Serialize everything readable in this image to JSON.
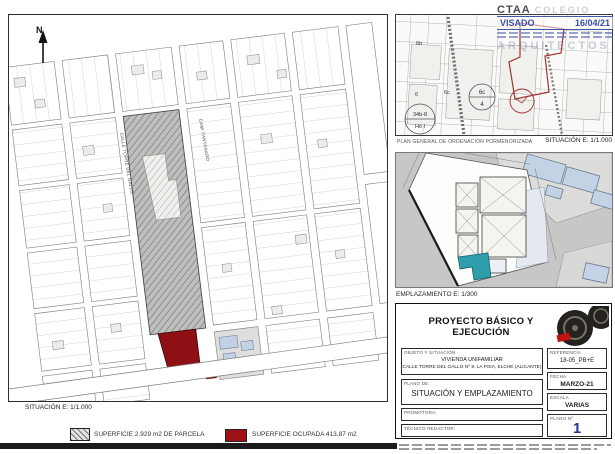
{
  "map": {
    "north": "N",
    "street_left": "CALLE TORRE DEL GALLO",
    "street_right": "CAMI PANTANARO",
    "caption": "SITUACIÓN E: 1/1.000"
  },
  "legend": {
    "parcela_label": "SUPERFICIE 2.929 m2 DE PARCELA",
    "ocupada_label": "SUPERFICIE OCUPADA  413,87 m2"
  },
  "pgou": {
    "caption": "PLAN GENERAL DE ORDENACIÓN PORMENORIZADA",
    "scale": "SITUACIÓN E: 1/1.000",
    "zone_6b": "6b",
    "zone_6c": "6c",
    "zone_6": "6",
    "circle1_top": "6c",
    "circle1_bottom": "4",
    "circle2_top": "34b-8",
    "circle2_bottom": "Ho I"
  },
  "stamp": {
    "org": "CTAA",
    "org_watermark": "COLEGIO",
    "visado": "VISADO",
    "date": "16/04/21",
    "watermark": "ARQUITECTOS"
  },
  "emplazamiento": {
    "caption": "EMPLAZAMIENTO E: 1/300"
  },
  "titleblock": {
    "title": "PROYECTO BÁSICO Y EJECUCIÓN",
    "objeto_label": "OBJETO Y SITUACIÓN",
    "objeto_line1": "VIVIENDA UNIFAMILIAR",
    "objeto_line2": "CALLE TORRE DEL GALLO Nº 9, LA FOIA, ELCHE (ALICANTE)",
    "plano_label": "PLANO DE:",
    "plano_value": "SITUACIÓN Y EMPLAZAMIENTO",
    "promotora_label": "PROMOTORA:",
    "tecnico_label": "TÉCNICO REDACTOR:",
    "referencia_label": "REFERENCIA",
    "referencia_value": "18-05_PB+E",
    "fecha_label": "FECHA",
    "fecha_value": "MARZO-21",
    "escala_label": "ESCALA",
    "escala_value": "VARIAS",
    "plano_num_label": "PLANO Nº",
    "plano_num_value": "1"
  }
}
